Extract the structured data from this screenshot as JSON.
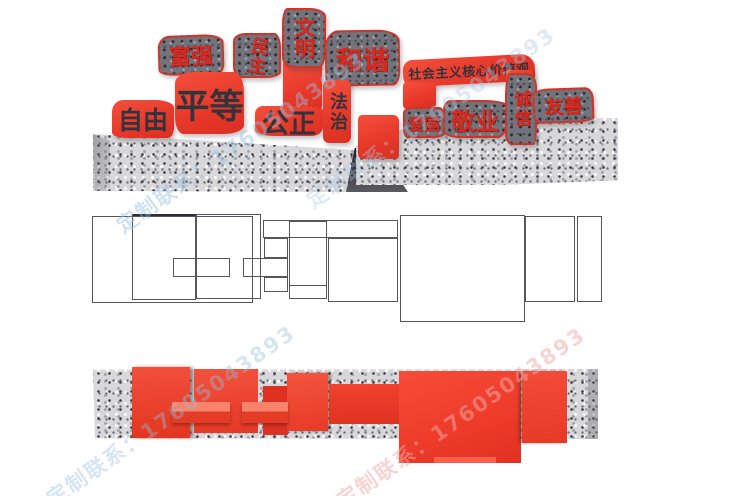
{
  "watermark": {
    "text": "定制联系：17605043893"
  },
  "front_view": {
    "banner": {
      "label": "社会主义核心价值观"
    },
    "granite_blocks": [
      {
        "id": "fuqiang",
        "label": "富强"
      },
      {
        "id": "minzhu",
        "label": "民主"
      },
      {
        "id": "wenming",
        "label": "文明"
      },
      {
        "id": "hexie",
        "label": "和谐"
      },
      {
        "id": "aiguo",
        "label": "爱国"
      },
      {
        "id": "jingye",
        "label": "敬业"
      },
      {
        "id": "chengxin",
        "label": "诚信"
      },
      {
        "id": "youshan",
        "label": "友善"
      }
    ],
    "red_blocks": [
      {
        "id": "ziyou",
        "label": "自由"
      },
      {
        "id": "pingdeng",
        "label": "平等"
      },
      {
        "id": "gongzheng",
        "label": "公正"
      },
      {
        "id": "fazhi",
        "label": "法治"
      }
    ]
  },
  "colors": {
    "red_primary": "#ee3b2a",
    "red_text": "#e0251a",
    "dark_text": "#33333b",
    "granite_light": "#d8d8da",
    "granite_dark": "#73737b",
    "wire_line": "#55555b",
    "watermark_blue": "#96bedc",
    "watermark_pink": "#f0aaa5"
  }
}
